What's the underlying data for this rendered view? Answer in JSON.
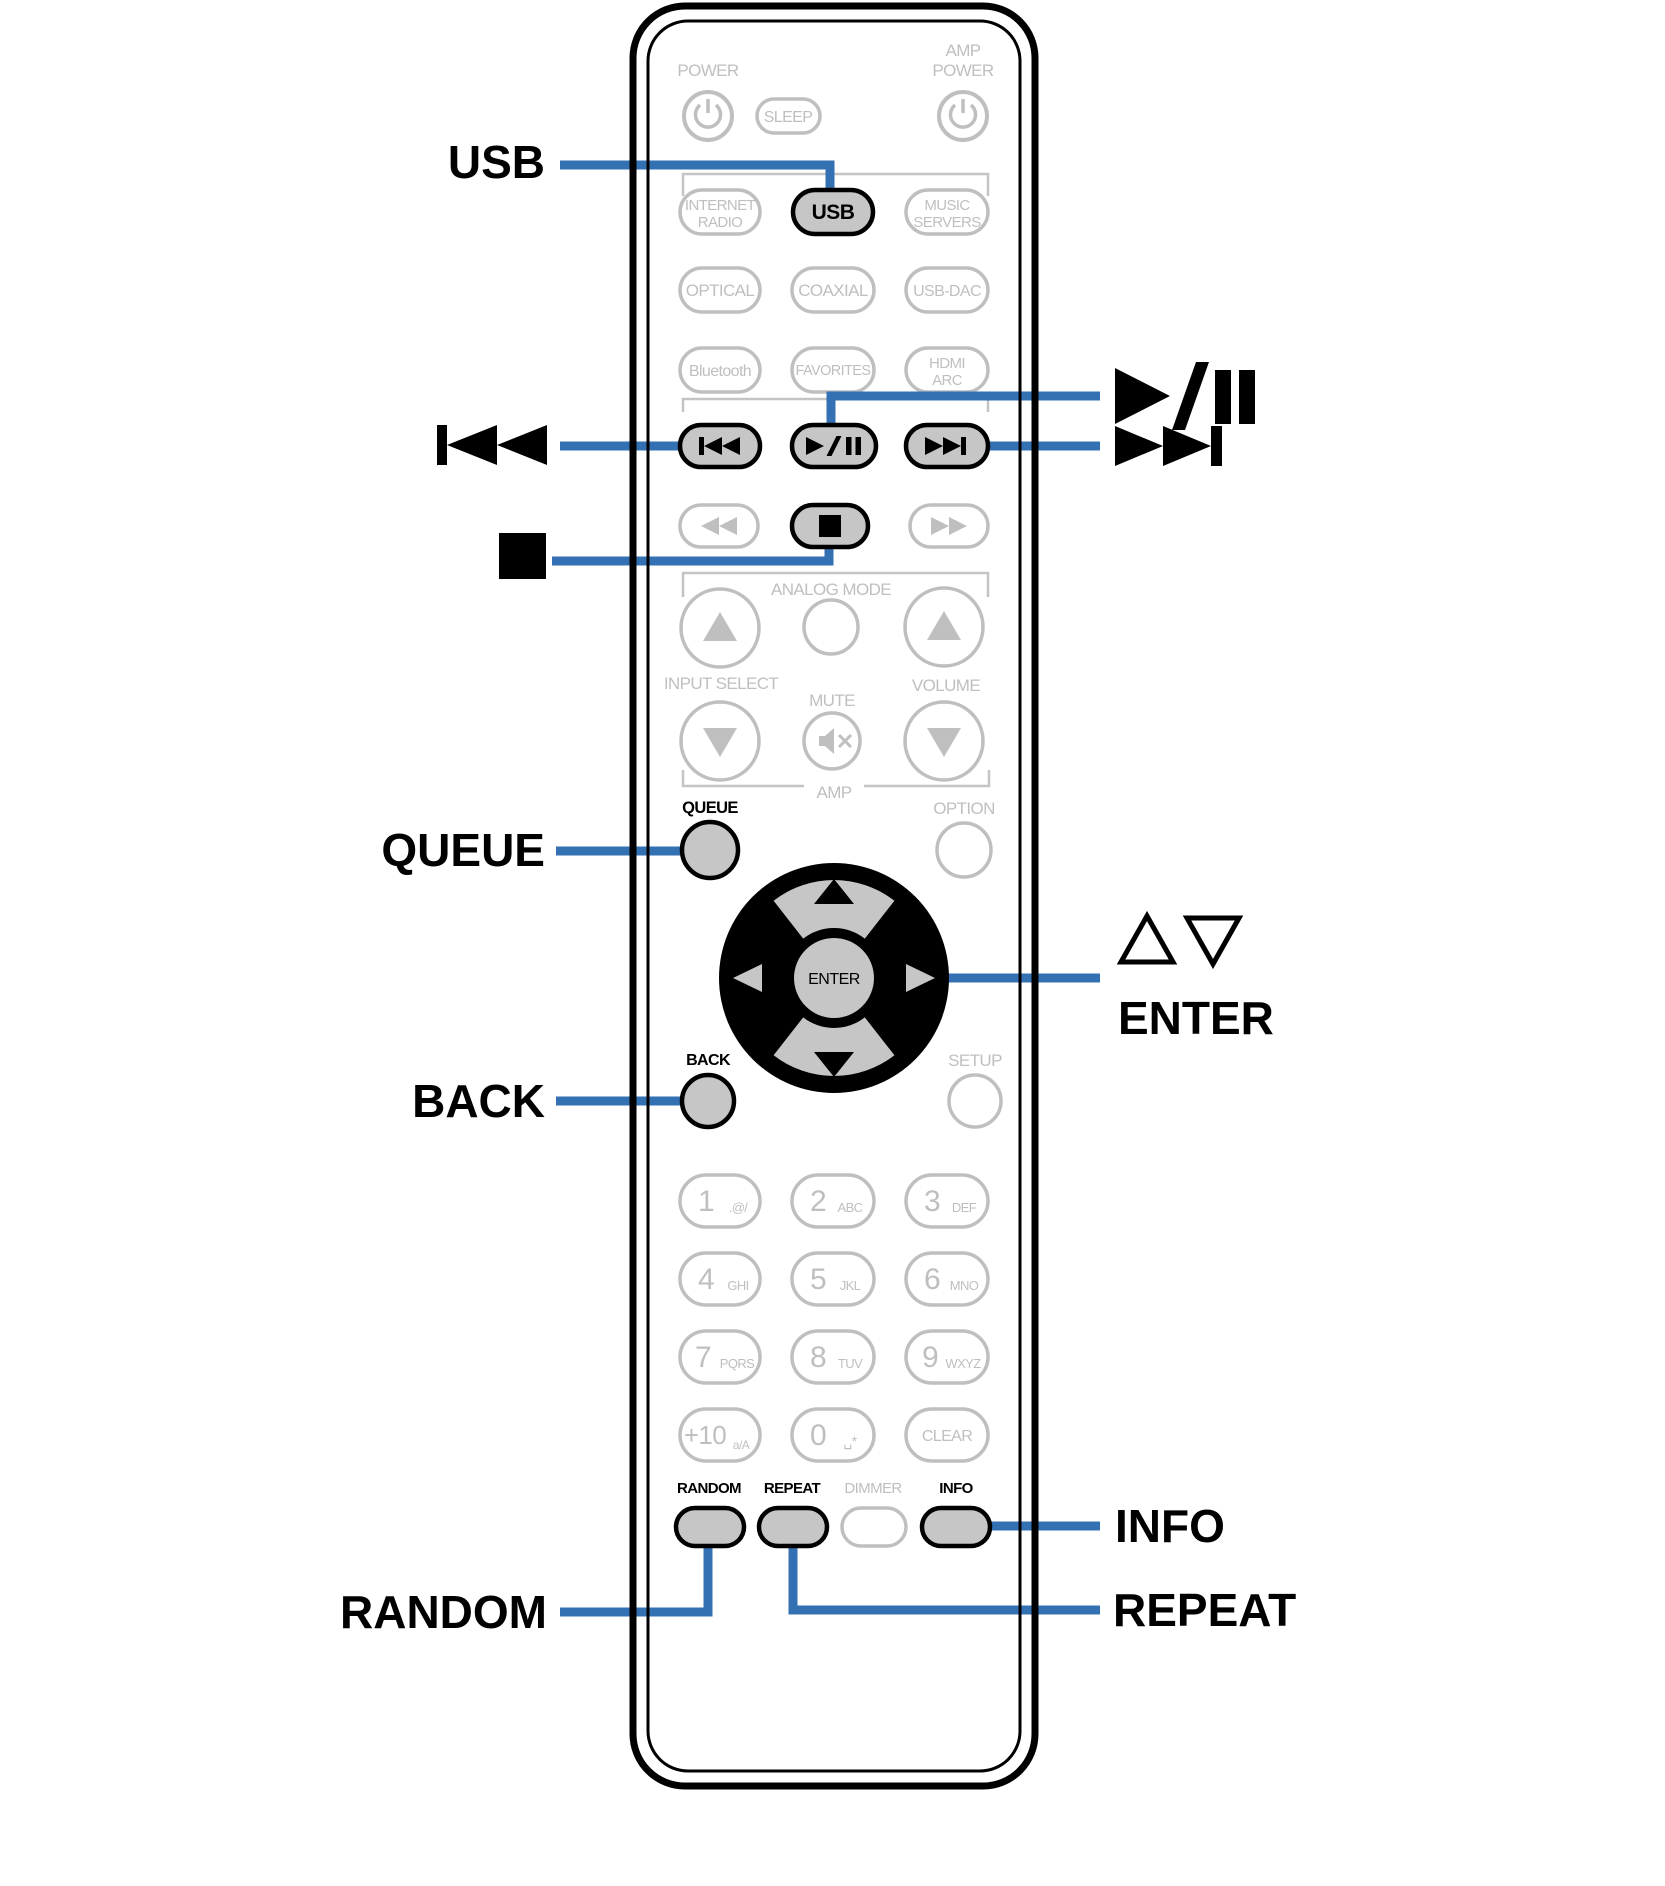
{
  "colors": {
    "accent_blue": "#3371B3",
    "inactive_gray": "#BFBFBF",
    "highlight_fill": "#C6C6C6",
    "ink": "#000000"
  },
  "callouts": {
    "usb": "USB",
    "queue": "QUEUE",
    "back": "BACK",
    "random": "RANDOM",
    "enter": "ENTER",
    "info": "INFO",
    "repeat": "REPEAT"
  },
  "remote": {
    "power": "POWER",
    "sleep": "SLEEP",
    "amp1": "AMP",
    "amp2": "POWER",
    "sources": {
      "internet1": "INTERNET",
      "internet2": "RADIO",
      "usb": "USB",
      "music1": "MUSIC",
      "music2": "SERVERS",
      "optical": "OPTICAL",
      "coaxial": "COAXIAL",
      "usbdac": "USB-DAC",
      "bluetooth": "Bluetooth",
      "favorites": "FAVORITES",
      "hdmi1": "HDMI",
      "hdmi2": "ARC"
    },
    "analog_mode": "ANALOG MODE",
    "input_select": "INPUT SELECT",
    "mute": "MUTE",
    "volume": "VOLUME",
    "amp_bracket": "AMP",
    "queue": "QUEUE",
    "option": "OPTION",
    "enter": "ENTER",
    "back": "BACK",
    "setup": "SETUP",
    "keypad": {
      "keys": [
        {
          "digit": "1",
          "sub": ".@/"
        },
        {
          "digit": "2",
          "sub": "ABC"
        },
        {
          "digit": "3",
          "sub": "DEF"
        },
        {
          "digit": "4",
          "sub": "GHI"
        },
        {
          "digit": "5",
          "sub": "JKL"
        },
        {
          "digit": "6",
          "sub": "MNO"
        },
        {
          "digit": "7",
          "sub": "PQRS"
        },
        {
          "digit": "8",
          "sub": "TUV"
        },
        {
          "digit": "9",
          "sub": "WXYZ"
        },
        {
          "digit": "+10",
          "sub": "a/A"
        },
        {
          "digit": "0",
          "sub": "␣*"
        }
      ],
      "clear": "CLEAR"
    },
    "bottom": {
      "random": "RANDOM",
      "repeat": "REPEAT",
      "dimmer": "DIMMER",
      "info": "INFO"
    }
  }
}
